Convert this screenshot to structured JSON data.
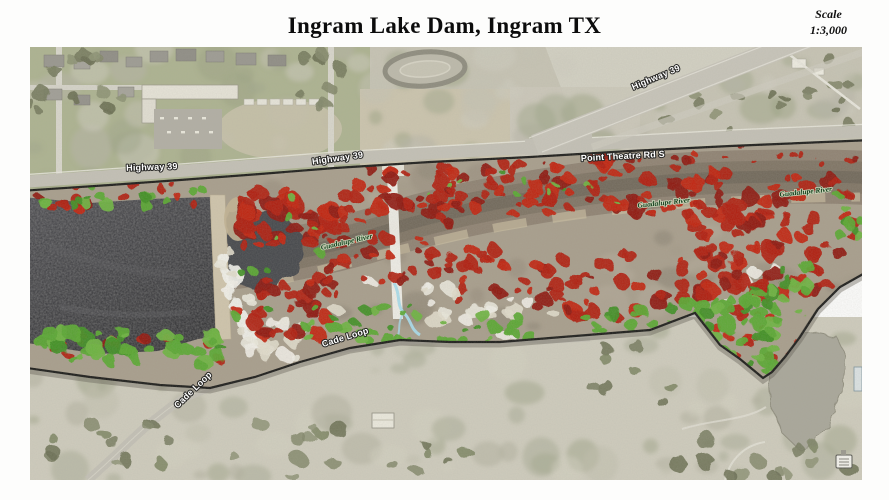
{
  "header": {
    "title": "Ingram Lake Dam, Ingram TX",
    "scale_label": "Scale",
    "scale_value": "1:3,000"
  },
  "map": {
    "labels": [
      {
        "id": "label-highway-39-west",
        "text": "Highway 39",
        "type": "road",
        "x": 122,
        "y": 123,
        "rot": -2
      },
      {
        "id": "label-highway-39-mid",
        "text": "Highway 39",
        "type": "road",
        "x": 308,
        "y": 114,
        "rot": -8
      },
      {
        "id": "label-highway-39-northeast",
        "text": "Highway 39",
        "type": "road",
        "x": 627,
        "y": 33,
        "rot": -23
      },
      {
        "id": "label-point-theatre-rd-s",
        "text": "Point Theatre Rd S",
        "type": "road",
        "x": 593,
        "y": 112,
        "rot": -3
      },
      {
        "id": "label-guadalupe-river-west",
        "text": "Guadalupe River",
        "type": "river",
        "x": 317,
        "y": 197,
        "rot": -13
      },
      {
        "id": "label-guadalupe-river-mid",
        "text": "Guadalupe River",
        "type": "river",
        "x": 634,
        "y": 158,
        "rot": -6
      },
      {
        "id": "label-guadalupe-river-east",
        "text": "Guadalupe River",
        "type": "river",
        "x": 776,
        "y": 147,
        "rot": -6
      },
      {
        "id": "label-cade-loop-mid",
        "text": "Cade Loop",
        "type": "road",
        "x": 316,
        "y": 293,
        "rot": -17
      },
      {
        "id": "label-cade-loop-southwest",
        "text": "Cade Loop",
        "type": "road",
        "x": 165,
        "y": 345,
        "rot": -44
      }
    ],
    "palette": {
      "terrain": "#c7c4b4",
      "terrain_green": "#a6af87",
      "road": "#c4c1b6",
      "boundary": "#1a1a18",
      "lake_dark": "#3b3b3f",
      "lake_edge": "#2e2e31",
      "river_brown": "#8d8171",
      "sand": "#cbbe9f",
      "veg_red": "#b11b0e",
      "veg_red_bright": "#c22312",
      "veg_red_dark": "#8e140a",
      "veg_green": "#5aa830",
      "veg_green_bright": "#6db33e",
      "veg_green_dark": "#3f8f23",
      "creek_blue": "#a8dcec",
      "concrete_white": "#f3f2ec",
      "pond": "#a9a79a",
      "tree": "#767a5d"
    }
  }
}
